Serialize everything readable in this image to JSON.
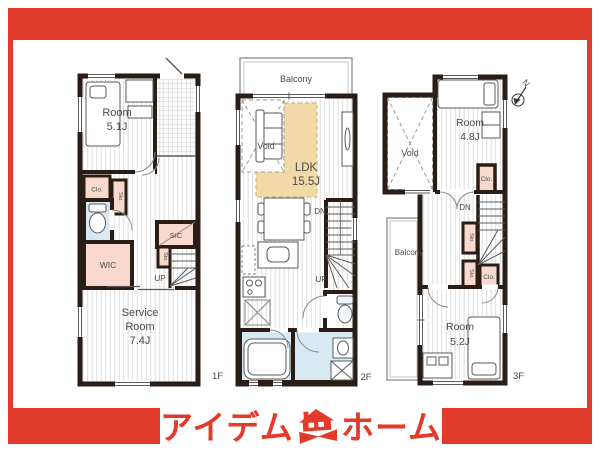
{
  "colors": {
    "accent_red": "#e23a2b",
    "wall": "#2a1d15",
    "closet_pink": "#f9d9ce",
    "wet_area_blue": "#d8e9f4",
    "ldk_tan": "#f1daa7"
  },
  "floor1": {
    "label": "1F",
    "room": {
      "l1": "Room",
      "l2": "5.1J"
    },
    "service": {
      "l1": "Service",
      "l2": "Room",
      "l3": "7.4J"
    },
    "clo": "Clo.",
    "sto_a": "Sto.",
    "sto_b": "Sto.",
    "wic": "WIC",
    "sic": "SIC",
    "up": "UP"
  },
  "floor2": {
    "label": "2F",
    "balcony": "Balcony",
    "void": "Void",
    "ldk": {
      "l1": "LDK",
      "l2": "15.5J"
    },
    "dn": "DN",
    "up": "UP"
  },
  "floor3": {
    "label": "3F",
    "north": "N",
    "room_a": {
      "l1": "Room",
      "l2": "4.8J"
    },
    "void": "Void",
    "clo_a": "Clo.",
    "dn": "DN",
    "sto_a": "Sto.",
    "sto_b": "Sto.",
    "clo_b": "Clo.",
    "balcony": "Balcony",
    "room_b": {
      "l1": "Room",
      "l2": "5.2J"
    }
  },
  "logo": {
    "left": "アイデム",
    "right": "ホーム"
  }
}
